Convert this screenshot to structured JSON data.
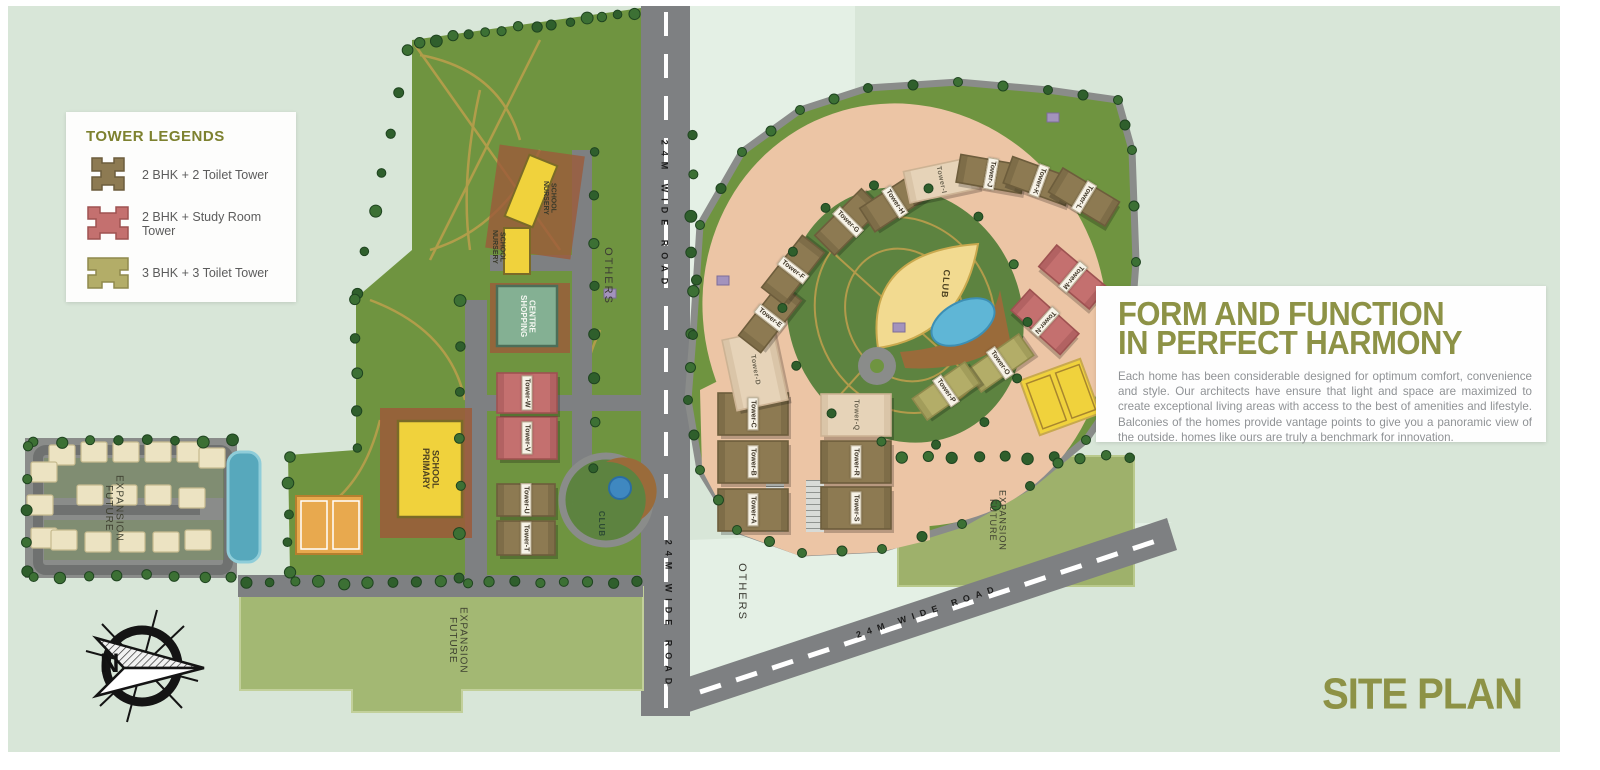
{
  "page": {
    "site_plan_title": "SITE PLAN",
    "background": "#d8e6d8"
  },
  "legend": {
    "title": "TOWER LEGENDS",
    "items": [
      {
        "id": "brown",
        "label": "2 BHK + 2 Toilet Tower",
        "color": "#8d7a52",
        "border": "#6d5d3c"
      },
      {
        "id": "pink",
        "label": "2 BHK + Study Room Tower",
        "color": "#c4706f",
        "border": "#9e5251"
      },
      {
        "id": "olive",
        "label": "3 BHK + 3 Toilet Tower",
        "color": "#b3ad68",
        "border": "#8f894c"
      }
    ]
  },
  "info_panel": {
    "heading_line1": "FORM AND FUNCTION",
    "heading_line2": "IN PERFECT HARMONY",
    "body": "Each home has been considerable designed for optimum comfort, convenience and style. Our architects have ensure that light and space are maximized to create exceptional living areas with access to the best of amenities and lifestyle. Balconies of the homes provide vantage points to give you a panoramic view of the outside. homes like ours are truly a benchmark for innovation."
  },
  "map": {
    "roads": {
      "vertical_top": "24M WIDE ROAD",
      "vertical_bottom": "24M WIDE ROAD",
      "diagonal": "24M WIDE ROAD"
    },
    "areas": {
      "others_top": "OTHERS",
      "others_bottom": "OTHERS",
      "future_expansion_left": "FUTURE EXPANSION",
      "future_expansion_bottom": "FUTURE EXPANSION",
      "future_expansion_right": "FUTURE EXPANSION"
    },
    "facilities": {
      "primary_school": "PRIMARY SCHOOL",
      "shopping_centre": "SHOPPING CENTRE",
      "nursery_school_upper": "NURSERY SCHOOL",
      "nursery_school_lower": "NURSERY SCHOOL",
      "club_central": "CLUB",
      "club_west": "CLUB"
    },
    "compass": {
      "north_label": "N"
    },
    "towers": [
      {
        "id": "A",
        "label": "Tower-A",
        "type": "brown"
      },
      {
        "id": "B",
        "label": "Tower-B",
        "type": "brown"
      },
      {
        "id": "C",
        "label": "Tower-C",
        "type": "brown"
      },
      {
        "id": "D",
        "label": "Tower-D",
        "type": "outline"
      },
      {
        "id": "E",
        "label": "Tower-E",
        "type": "brown"
      },
      {
        "id": "F",
        "label": "Tower-F",
        "type": "brown"
      },
      {
        "id": "G",
        "label": "Tower-G",
        "type": "brown"
      },
      {
        "id": "H",
        "label": "Tower-H",
        "type": "brown"
      },
      {
        "id": "I",
        "label": "Tower-I",
        "type": "outline"
      },
      {
        "id": "J",
        "label": "Tower-J",
        "type": "brown"
      },
      {
        "id": "K",
        "label": "Tower-K",
        "type": "brown"
      },
      {
        "id": "L",
        "label": "Tower-L",
        "type": "brown"
      },
      {
        "id": "M",
        "label": "Tower-M",
        "type": "pink"
      },
      {
        "id": "N",
        "label": "Tower-N",
        "type": "pink"
      },
      {
        "id": "O",
        "label": "Tower-O",
        "type": "olive"
      },
      {
        "id": "P",
        "label": "Tower-P",
        "type": "olive"
      },
      {
        "id": "Q",
        "label": "Tower-Q",
        "type": "outline"
      },
      {
        "id": "R",
        "label": "Tower-R",
        "type": "brown"
      },
      {
        "id": "S",
        "label": "Tower-S",
        "type": "brown"
      },
      {
        "id": "T",
        "label": "Tower-T",
        "type": "brown"
      },
      {
        "id": "U",
        "label": "Tower-U",
        "type": "brown"
      },
      {
        "id": "V",
        "label": "Tower-V",
        "type": "pink"
      },
      {
        "id": "W",
        "label": "Tower-W",
        "type": "pink"
      }
    ]
  }
}
